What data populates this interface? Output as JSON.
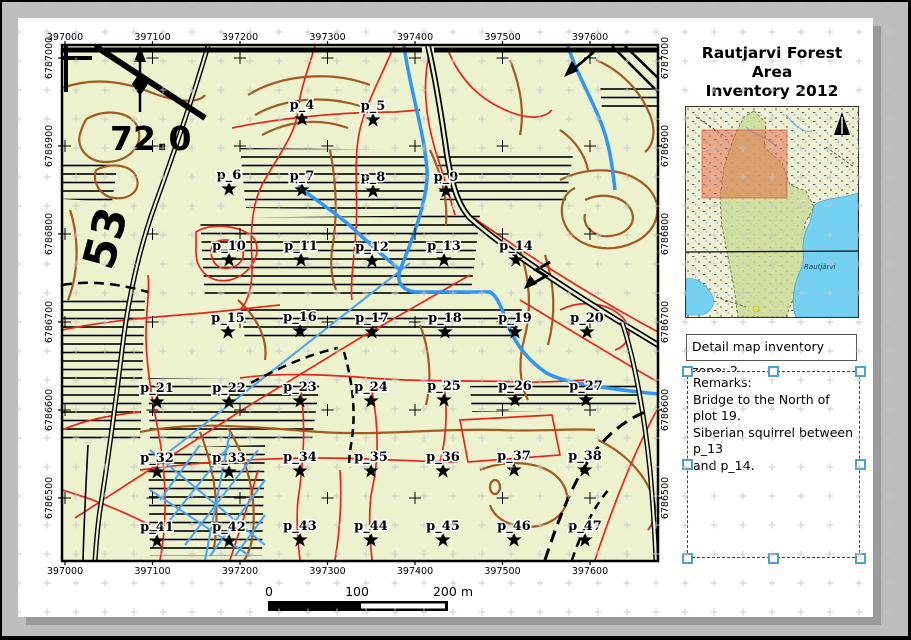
{
  "title": {
    "line1": "Rautjarvi Forest Area",
    "line2": "Inventory 2012"
  },
  "detail_box": {
    "label": "Detail map inventory zone: 2"
  },
  "remarks_box": {
    "lines": [
      "Remarks:",
      "Bridge to the North of plot 19.",
      "Siberian squirrel between p_13",
      "and p_14."
    ]
  },
  "overview": {
    "lake_label": "Rautjärvi"
  },
  "map": {
    "grid": {
      "x_labels": [
        "397000",
        "397100",
        "397200",
        "397300",
        "397400",
        "397500",
        "397600"
      ],
      "y_labels": [
        "6787000",
        "6786900",
        "6786800",
        "6786700",
        "6786600",
        "6786500"
      ],
      "x0": 65,
      "x_step": 87.5,
      "y0": 58,
      "y_step": 88
    },
    "big_labels": {
      "parcel_number": "72.0",
      "parcel_number_rotated": "53"
    },
    "plots": [
      {
        "id": "p_4",
        "x": 302,
        "y": 119
      },
      {
        "id": "p_5",
        "x": 373,
        "y": 120
      },
      {
        "id": "p_6",
        "x": 229,
        "y": 189
      },
      {
        "id": "p_7",
        "x": 302,
        "y": 190
      },
      {
        "id": "p_8",
        "x": 373,
        "y": 191
      },
      {
        "id": "p_9",
        "x": 446,
        "y": 191
      },
      {
        "id": "p_10",
        "x": 229,
        "y": 260
      },
      {
        "id": "p_11",
        "x": 301,
        "y": 260
      },
      {
        "id": "p_12",
        "x": 372,
        "y": 261
      },
      {
        "id": "p_13",
        "x": 444,
        "y": 260
      },
      {
        "id": "p_14",
        "x": 516,
        "y": 260
      },
      {
        "id": "p_15",
        "x": 228,
        "y": 332
      },
      {
        "id": "p_16",
        "x": 300,
        "y": 331
      },
      {
        "id": "p_17",
        "x": 372,
        "y": 332
      },
      {
        "id": "p_18",
        "x": 445,
        "y": 332
      },
      {
        "id": "p_19",
        "x": 515,
        "y": 332
      },
      {
        "id": "p_20",
        "x": 587,
        "y": 332
      },
      {
        "id": "p_21",
        "x": 157,
        "y": 402
      },
      {
        "id": "p_22",
        "x": 229,
        "y": 402
      },
      {
        "id": "p_23",
        "x": 300,
        "y": 401
      },
      {
        "id": "p_24",
        "x": 371,
        "y": 401
      },
      {
        "id": "p_25",
        "x": 444,
        "y": 400
      },
      {
        "id": "p_26",
        "x": 515,
        "y": 400
      },
      {
        "id": "p_27",
        "x": 586,
        "y": 400
      },
      {
        "id": "p_32",
        "x": 157,
        "y": 472
      },
      {
        "id": "p_33",
        "x": 229,
        "y": 472
      },
      {
        "id": "p_34",
        "x": 300,
        "y": 471
      },
      {
        "id": "p_35",
        "x": 371,
        "y": 471
      },
      {
        "id": "p_36",
        "x": 443,
        "y": 471
      },
      {
        "id": "p_37",
        "x": 514,
        "y": 470
      },
      {
        "id": "p_38",
        "x": 585,
        "y": 470
      },
      {
        "id": "p_41",
        "x": 157,
        "y": 541
      },
      {
        "id": "p_42",
        "x": 229,
        "y": 541
      },
      {
        "id": "p_43",
        "x": 300,
        "y": 540
      },
      {
        "id": "p_44",
        "x": 371,
        "y": 540
      },
      {
        "id": "p_45",
        "x": 443,
        "y": 540
      },
      {
        "id": "p_46",
        "x": 514,
        "y": 540
      },
      {
        "id": "p_47",
        "x": 585,
        "y": 540
      }
    ],
    "scalebar": {
      "labels": [
        {
          "text": "0",
          "x": 269
        },
        {
          "text": "100",
          "x": 357
        },
        {
          "text": "200 m",
          "x": 453
        }
      ]
    }
  },
  "colors": {
    "map_bg": "#ebf2cd",
    "contour_brown": "#a4591e",
    "boundary_red": "#e7261b",
    "stream_blue": "#2f96f5",
    "ditch_blue": "#4aa3f2",
    "road_black": "#000000",
    "canvas_bg": "#bdbdbd",
    "page_shadow": "#9a9a9a",
    "overview_green": "#c9da93",
    "overview_lake": "#74d1f2",
    "extent_highlight": "#e2603c",
    "selection_handle": "#4da0d0",
    "selection_dash": "#7c2430"
  }
}
